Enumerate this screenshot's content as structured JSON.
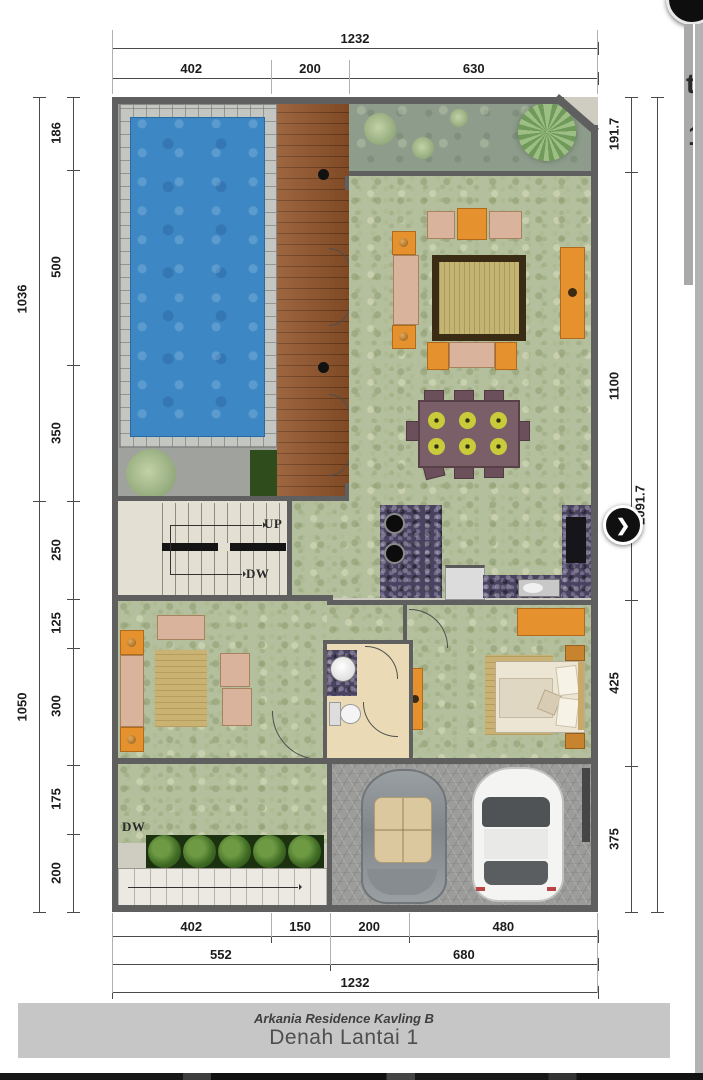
{
  "viewer": {
    "next_button": "❯",
    "edge_fragment_top": "t",
    "edge_fragment_bottom": "1"
  },
  "titleblock": {
    "subtitle": "Arkania Residence Kavling B",
    "title": "Denah Lantai 1"
  },
  "dims": {
    "top_overall": "1232",
    "top_segments": [
      "402",
      "200",
      "630"
    ],
    "left_upper_overall": "1036",
    "left_upper_segments": [
      "186",
      "500",
      "350"
    ],
    "left_lower_overall": "1050",
    "left_lower_segments": [
      "250",
      "125",
      "300",
      "175",
      "200"
    ],
    "right_segments": [
      "191.7",
      "1100",
      "425",
      "375"
    ],
    "right_overall": "2091.7",
    "bottom_row1": [
      "402",
      "150",
      "200",
      "480"
    ],
    "bottom_row2": [
      "552",
      "680"
    ],
    "bottom_overall": "1232"
  },
  "labels": {
    "stairs_up": "UP",
    "stairs_down": "DW",
    "garden_down": "DW"
  },
  "colors": {
    "pool_water": "#3d88c4",
    "pool_tile": "#c3c6c1",
    "deck_wood": "#93552a",
    "lawn_green": "#b4bf9d",
    "garden_strip": "#8d9c8b",
    "wall_gray": "#5f5f5f",
    "furniture_orange": "#e5912d",
    "counter_granite": "#4a4360",
    "title_bar_bg": "#c6c6c6"
  }
}
